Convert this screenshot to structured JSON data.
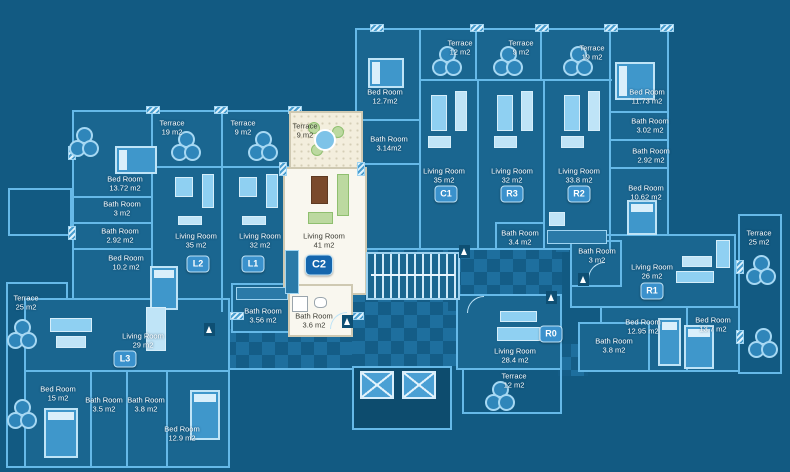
{
  "title": "Residential floor plan blueprint",
  "palette": {
    "background": "#125a82",
    "room_fill": "#1a6690",
    "wall": "#66b9e8",
    "furniture": "#8fd0f2",
    "text": "#ffffff",
    "badge": "#3a91cc",
    "selected_badge": "#1566ad",
    "selected_unit_fill": "#f9f7ef",
    "checker_light": "#1e6f9e",
    "checker_dark": "#145d87"
  },
  "badges": {
    "l1": "L1",
    "l2": "L2",
    "l3": "L3",
    "c1": "C1",
    "c2": "C2",
    "r0": "R0",
    "r1": "R1",
    "r2": "R2",
    "r3": "R3"
  },
  "labels": {
    "t19l": {
      "room": "Terrace",
      "area": "19 m2"
    },
    "t9l": {
      "room": "Terrace",
      "area": "9 m2"
    },
    "bed1372": {
      "room": "Bed Room",
      "area": "13.72 m2"
    },
    "bath3l": {
      "room": "Bath Room",
      "area": "3 m2"
    },
    "bath292l": {
      "room": "Bath Room",
      "area": "2.92 m2"
    },
    "bed102": {
      "room": "Bed Room",
      "area": "10.2 m2"
    },
    "liv35l2": {
      "room": "Living Room",
      "area": "35 m2"
    },
    "liv32l1": {
      "room": "Living Room",
      "area": "32 m2"
    },
    "t9c": {
      "room": "Terrace",
      "area": "9 m2"
    },
    "liv41c2": {
      "room": "Living Room",
      "area": "41 m2"
    },
    "bath356": {
      "room": "Bath Room",
      "area": "3.56 m2"
    },
    "bath36": {
      "room": "Bath Room",
      "area": "3.6 m2"
    },
    "bed127": {
      "room": "Bed Room",
      "area": "12.7m2"
    },
    "bath314": {
      "room": "Bath Room",
      "area": "3.14m2"
    },
    "t12t": {
      "room": "Terrace",
      "area": "12 m2"
    },
    "t9t": {
      "room": "Terrace",
      "area": "9 m2"
    },
    "t19t": {
      "room": "Terrace",
      "area": "19 m2"
    },
    "liv35c1": {
      "room": "Living Room",
      "area": "35 m2"
    },
    "liv32r3": {
      "room": "Living Room",
      "area": "32 m2"
    },
    "liv338r2": {
      "room": "Living Room",
      "area": "33.8 m2"
    },
    "bed1173": {
      "room": "Bed Room",
      "area": "11.73 m2"
    },
    "bath302": {
      "room": "Bath Room",
      "area": "3.02 m2"
    },
    "bath292r": {
      "room": "Bath Room",
      "area": "2.92 m2"
    },
    "bed1062": {
      "room": "Bed Room",
      "area": "10.62 m2"
    },
    "bath34": {
      "room": "Bath Room",
      "area": "3.4 m2"
    },
    "t25r": {
      "room": "Terrace",
      "area": "25 m2"
    },
    "bath3r": {
      "room": "Bath Room",
      "area": "3 m2"
    },
    "liv26r1": {
      "room": "Living Room",
      "area": "26 m2"
    },
    "bed1295": {
      "room": "Bed Room",
      "area": "12.95 m2"
    },
    "bed137": {
      "room": "Bed Room",
      "area": "13.7 m2"
    },
    "liv284r0": {
      "room": "Living Room",
      "area": "28.4 m2"
    },
    "t12b": {
      "room": "Terrace",
      "area": "12 m2"
    },
    "bath38r0": {
      "room": "Bath Room",
      "area": "3.8 m2"
    },
    "t25l": {
      "room": "Terrace",
      "area": "25 m2"
    },
    "liv29l3": {
      "room": "Living Room",
      "area": "29 m2"
    },
    "bed15": {
      "room": "Bed Room",
      "area": "15 m2"
    },
    "bath35": {
      "room": "Bath Room",
      "area": "3.5 m2"
    },
    "bath38l3": {
      "room": "Bath Room",
      "area": "3.8 m2"
    },
    "bed129": {
      "room": "Bed Room",
      "area": "12.9 m2"
    }
  }
}
